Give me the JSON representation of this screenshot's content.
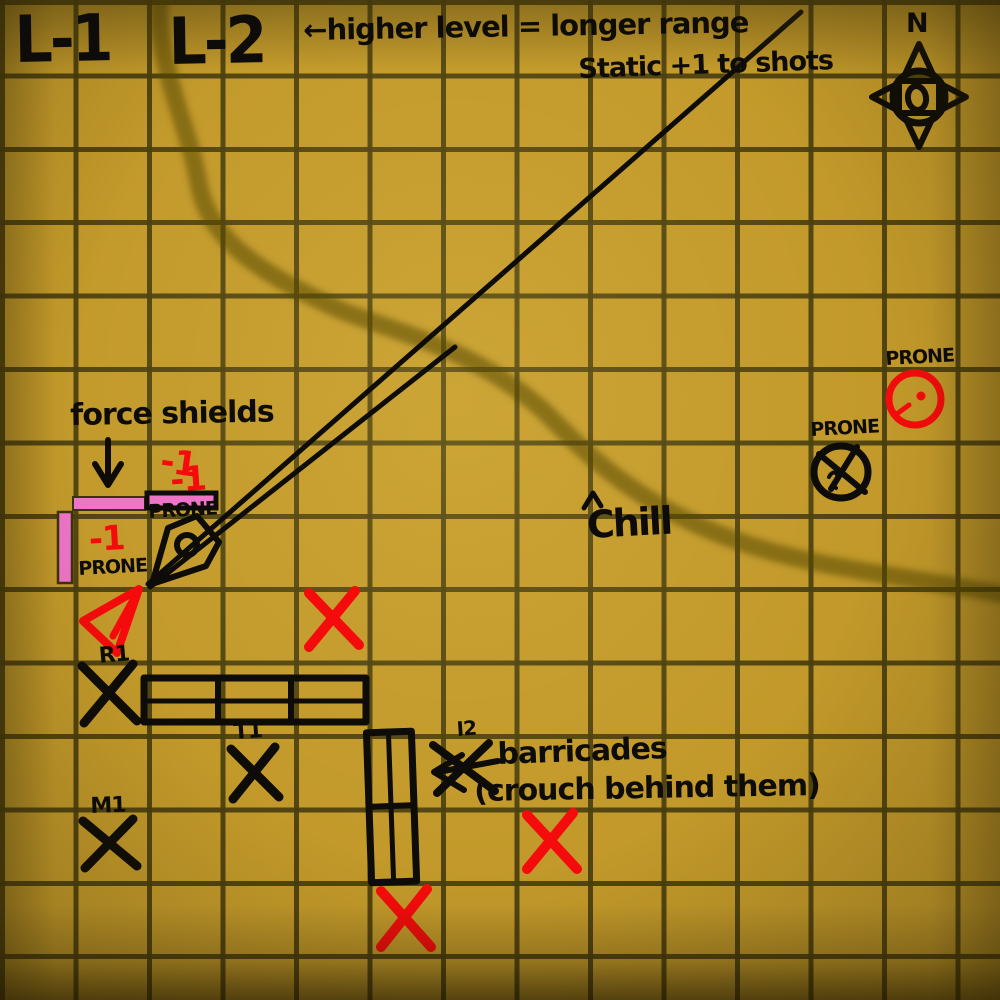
{
  "levels": {
    "l1": "L-1",
    "l2": "L-2"
  },
  "annotations": {
    "range_rule_line1": "←higher level = longer range",
    "range_rule_line2": "Static +1 to shots",
    "force_shields": "force shields",
    "barricades_title": "barricades",
    "barricades_sub": "(crouch behind them)",
    "chill": "Chill"
  },
  "compass": {
    "north": "N"
  },
  "penalties": {
    "top": "-1",
    "mid": "-1",
    "left": "-1"
  },
  "prone": {
    "shield_top": "PRONE",
    "shield_left": "PRONE",
    "mid_right": "PRONE",
    "far_right": "PRONE"
  },
  "units": {
    "r1": "R1",
    "t1": "T1",
    "i2": "I2",
    "m1": "M1"
  },
  "markers": {
    "black_x_marks": [
      "R1",
      "T1",
      "M1",
      "I2"
    ],
    "red_x_marks_count": 3,
    "prone_tokens": [
      "red-circle-token",
      "black-crossed-circle-token"
    ],
    "force_shield_bars": [
      "horizontal-left",
      "horizontal-right-outlined",
      "vertical-left"
    ],
    "barricades": [
      "horizontal-3-segment",
      "vertical-2-segment"
    ],
    "line_of_sight_lines": 2
  },
  "colors": {
    "board_gold": "#c2992a",
    "grid_line": "#4d400e",
    "ink_black": "#0e0c08",
    "mark_red": "#f50b0b",
    "shield_pink": "#ee74c8",
    "river_shadow": "#564708"
  }
}
